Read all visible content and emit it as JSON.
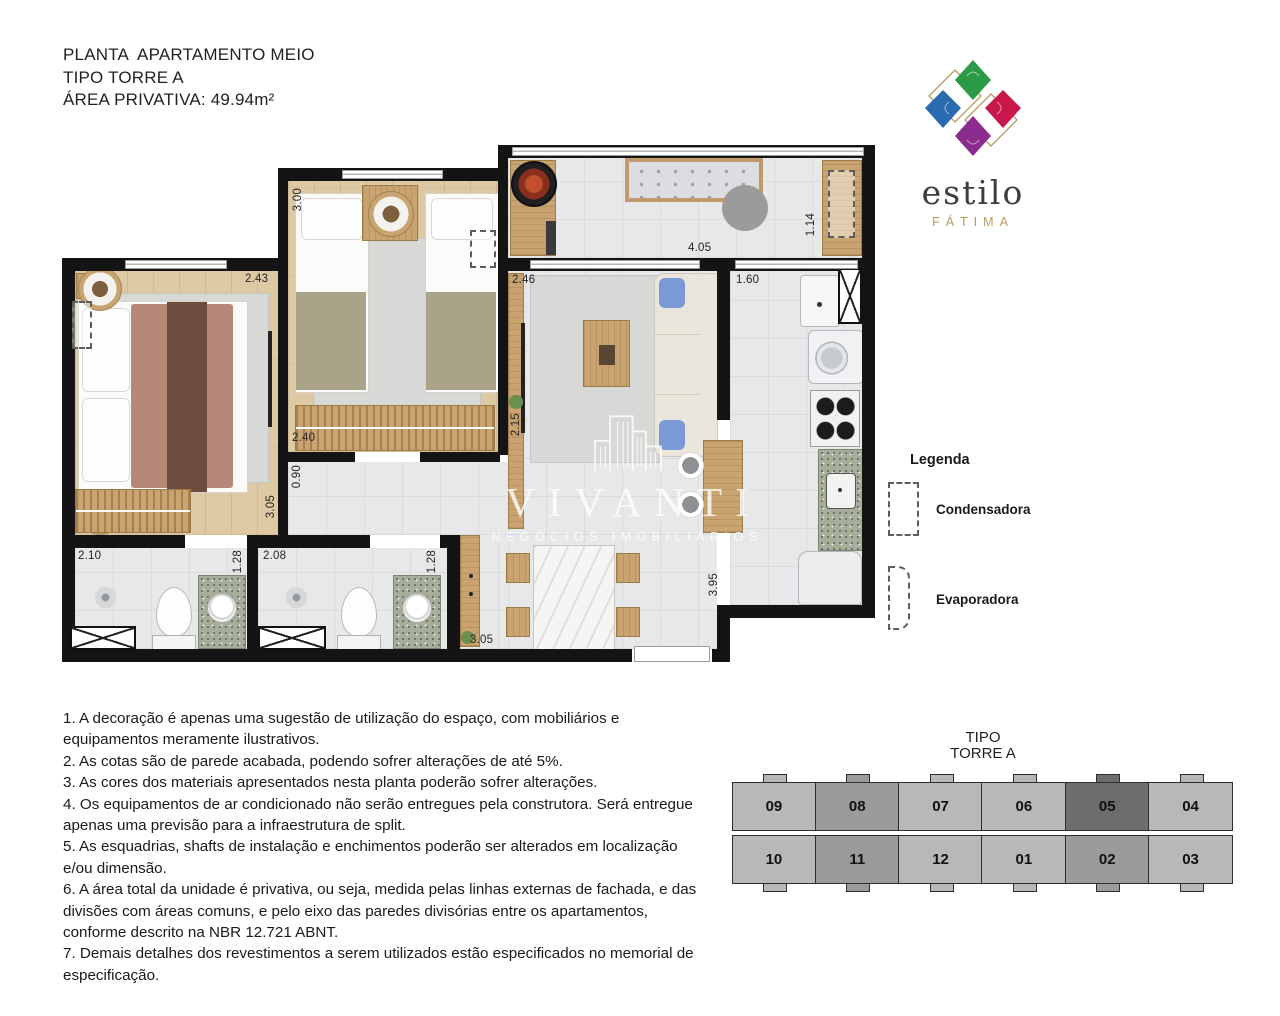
{
  "title": {
    "line1": "PLANTA  APARTAMENTO MEIO",
    "line2": "TIPO TORRE A",
    "line3": "ÁREA PRIVATIVA: 49.94m²"
  },
  "logo": {
    "name": "estilo",
    "subname": "FÁTIMA",
    "colors": {
      "green": "#2b9a47",
      "red": "#c8184b",
      "purple": "#8a2d8f",
      "blue": "#2a6bb0",
      "gold": "#b69a62"
    }
  },
  "watermark": {
    "name": "VIVANTI",
    "tagline": "NEGÓCIOS IMOBILIÁRIOS"
  },
  "legend": {
    "title": "Legenda",
    "items": [
      {
        "label": "Condensadora"
      },
      {
        "label": "Evaporadora"
      }
    ]
  },
  "plan": {
    "dimensions": {
      "suite_width": "2.43",
      "bedroom2_depth": "3.00",
      "living_width": "2.46",
      "terrace_width": "4.05",
      "terrace_counter": "1.14",
      "kitchen_opening": "1.60",
      "bedroom2_width": "2.40",
      "hall_width": "0.90",
      "suite_depth": "3.05",
      "living_depth": "2.15",
      "bath1_width": "2.10",
      "bath1_depth": "1.28",
      "bath2_width": "2.08",
      "bath2_depth": "1.28",
      "dining_width": "3.05",
      "kitchen_depth": "3.95"
    }
  },
  "notes": [
    "1. A decoração é apenas uma sugestão de utilização do espaço, com mobiliários e equipamentos meramente ilustrativos.",
    "2. As cotas são de parede acabada, podendo sofrer alterações de até 5%.",
    "3. As cores dos materiais apresentados nesta planta poderão sofrer alterações.",
    "4. Os equipamentos de ar condicionado não serão entregues pela construtora. Será entregue apenas uma previsão para a infraestrutura de split.",
    "5. As esquadrias, shafts de instalação e enchimentos poderão ser alterados em localização e/ou dimensão.",
    "6. A área total da unidade é privativa, ou seja, medida pelas linhas externas de fachada, e das divisões com áreas comuns, e pelo eixo das paredes divisórias entre os apartamentos, conforme descrito na NBR 12.721 ABNT.",
    "7. Demais detalhes dos revestimentos a serem utilizados estão especificados no memorial de especificação."
  ],
  "keyplan": {
    "title_line1": "TIPO",
    "title_line2": "TORRE A",
    "highlighted_unit": "05",
    "rows": [
      [
        {
          "label": "09",
          "shade": "light"
        },
        {
          "label": "08",
          "shade": "medium"
        },
        {
          "label": "07",
          "shade": "light"
        },
        {
          "label": "06",
          "shade": "light"
        },
        {
          "label": "05",
          "shade": "dark"
        },
        {
          "label": "04",
          "shade": "light"
        }
      ],
      [
        {
          "label": "10",
          "shade": "light"
        },
        {
          "label": "11",
          "shade": "medium"
        },
        {
          "label": "12",
          "shade": "light"
        },
        {
          "label": "01",
          "shade": "light"
        },
        {
          "label": "02",
          "shade": "medium"
        },
        {
          "label": "03",
          "shade": "light"
        }
      ]
    ]
  }
}
